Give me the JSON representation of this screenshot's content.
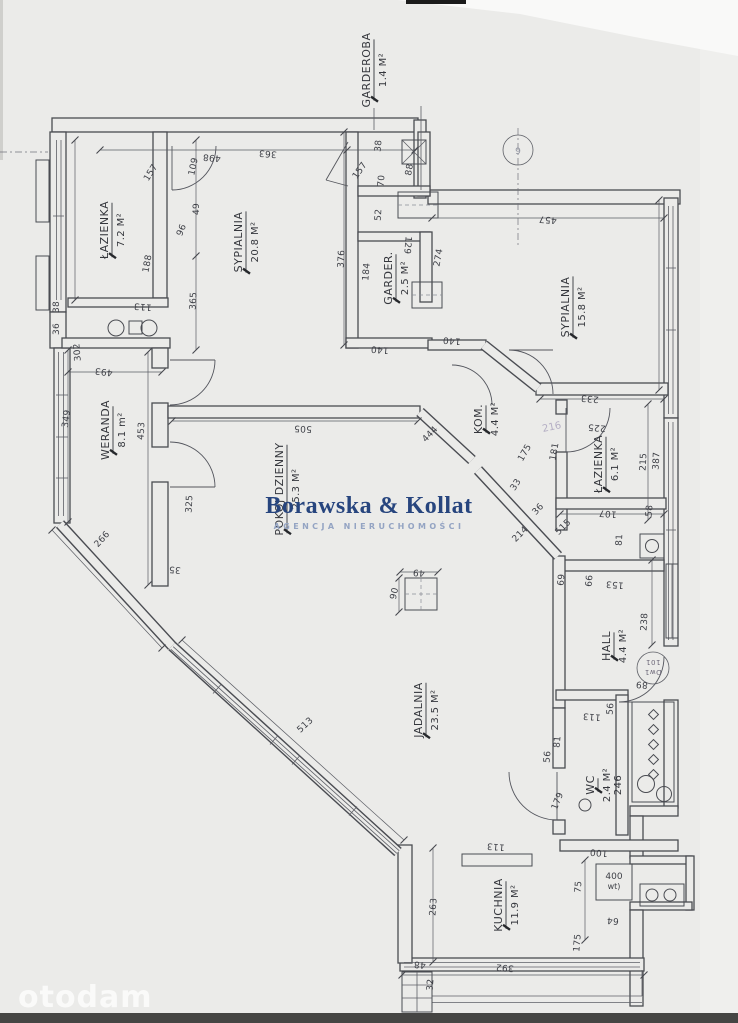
{
  "watermark": {
    "brand": "Borawska & Kollat",
    "subtitle": "AGENCJA NIERUCHOMOŚCI",
    "portal": "otodam"
  },
  "annotations": {
    "grid_marker": "9",
    "entry_stamp_top": "Dw1",
    "entry_stamp_bottom": "101",
    "boiler_top": "400",
    "boiler_bottom": "wt)",
    "corner_stamp": "216"
  },
  "colors": {
    "paper": "#ebebe9",
    "ink": "#4a4c52",
    "brand_navy": "#27457e",
    "brand_light": "#94a4c3",
    "portal_white": "#fbfbfa"
  },
  "rooms": [
    {
      "name": "ŁAZIENKA",
      "area": "7.2 M²",
      "x": 112,
      "y": 230
    },
    {
      "name": "SYPIALNIA",
      "area": "20.8 M²",
      "x": 246,
      "y": 242
    },
    {
      "name": "GARDEROBA",
      "area": "1.4 M²",
      "x": 374,
      "y": 70
    },
    {
      "name": "GARDER.",
      "area": "2.5 M²",
      "x": 396,
      "y": 278
    },
    {
      "name": "SYPIALNIA",
      "area": "15.8 M²",
      "x": 573,
      "y": 307
    },
    {
      "name": "WERANDA",
      "area": "8.1 m²",
      "x": 113,
      "y": 430
    },
    {
      "name": "POKOJ DZIENNY",
      "area": "25.3 M²",
      "x": 287,
      "y": 489
    },
    {
      "name": "KOM.",
      "area": "4.4 M²",
      "x": 486,
      "y": 419
    },
    {
      "name": "ŁAZIENKA",
      "area": "6.1 M²",
      "x": 606,
      "y": 464
    },
    {
      "name": "HALL",
      "area": "4.4 M²",
      "x": 614,
      "y": 646
    },
    {
      "name": "JADALNIA",
      "area": "23.5 M²",
      "x": 426,
      "y": 710
    },
    {
      "name": "WC",
      "area": "2.4 M²",
      "extra": "246",
      "x": 598,
      "y": 785
    },
    {
      "name": "KUCHNIA",
      "area": "11.9 M²",
      "x": 506,
      "y": 905
    }
  ],
  "dimensions": [
    {
      "v": "498",
      "x": 212,
      "y": 155,
      "r": 185
    },
    {
      "v": "363",
      "x": 268,
      "y": 151,
      "r": 185
    },
    {
      "v": "302",
      "x": 80,
      "y": 352,
      "r": -95
    },
    {
      "v": "157",
      "x": 153,
      "y": 174,
      "r": -58
    },
    {
      "v": "109",
      "x": 196,
      "y": 167,
      "r": -78
    },
    {
      "v": "49",
      "x": 199,
      "y": 209,
      "r": -90
    },
    {
      "v": "96",
      "x": 184,
      "y": 231,
      "r": -68
    },
    {
      "v": "188",
      "x": 150,
      "y": 264,
      "r": -80
    },
    {
      "v": "365",
      "x": 196,
      "y": 301,
      "r": -87
    },
    {
      "v": "113",
      "x": 143,
      "y": 304,
      "r": 185
    },
    {
      "v": "38",
      "x": 59,
      "y": 307,
      "r": -90
    },
    {
      "v": "36",
      "x": 59,
      "y": 329,
      "r": -90
    },
    {
      "v": "493",
      "x": 104,
      "y": 369,
      "r": 186
    },
    {
      "v": "349",
      "x": 69,
      "y": 419,
      "r": -82
    },
    {
      "v": "453",
      "x": 144,
      "y": 431,
      "r": -87
    },
    {
      "v": "325",
      "x": 192,
      "y": 504,
      "r": -87
    },
    {
      "v": "266",
      "x": 104,
      "y": 541,
      "r": -47
    },
    {
      "v": "35",
      "x": 175,
      "y": 567,
      "r": 185
    },
    {
      "v": "513",
      "x": 307,
      "y": 727,
      "r": -43
    },
    {
      "v": "38",
      "x": 381,
      "y": 146,
      "r": -85
    },
    {
      "v": "88",
      "x": 412,
      "y": 170,
      "r": -80
    },
    {
      "v": "157",
      "x": 362,
      "y": 172,
      "r": -55
    },
    {
      "v": "70",
      "x": 384,
      "y": 181,
      "r": -85
    },
    {
      "v": "52",
      "x": 381,
      "y": 215,
      "r": -86
    },
    {
      "v": "376",
      "x": 344,
      "y": 259,
      "r": -87
    },
    {
      "v": "184",
      "x": 369,
      "y": 272,
      "r": -85
    },
    {
      "v": "129",
      "x": 405,
      "y": 245,
      "r": 95
    },
    {
      "v": "274",
      "x": 441,
      "y": 258,
      "r": -80
    },
    {
      "v": "140",
      "x": 452,
      "y": 338,
      "r": 185
    },
    {
      "v": "140",
      "x": 380,
      "y": 347,
      "r": 185
    },
    {
      "v": "505",
      "x": 303,
      "y": 426,
      "r": 182
    },
    {
      "v": "444",
      "x": 432,
      "y": 436,
      "r": -46
    },
    {
      "v": "457",
      "x": 548,
      "y": 217,
      "r": 185
    },
    {
      "v": "387",
      "x": 659,
      "y": 461,
      "r": -87
    },
    {
      "v": "233",
      "x": 590,
      "y": 396,
      "r": 185
    },
    {
      "v": "225",
      "x": 597,
      "y": 425,
      "r": 185
    },
    {
      "v": "175",
      "x": 527,
      "y": 454,
      "r": -60
    },
    {
      "v": "181",
      "x": 557,
      "y": 452,
      "r": -80
    },
    {
      "v": "215",
      "x": 646,
      "y": 462,
      "r": -87
    },
    {
      "v": "33",
      "x": 518,
      "y": 486,
      "r": -58
    },
    {
      "v": "36",
      "x": 540,
      "y": 511,
      "r": -47
    },
    {
      "v": "214",
      "x": 522,
      "y": 536,
      "r": -45
    },
    {
      "v": "515",
      "x": 565,
      "y": 529,
      "r": -45
    },
    {
      "v": "107",
      "x": 608,
      "y": 511,
      "r": 185
    },
    {
      "v": "58",
      "x": 652,
      "y": 511,
      "r": -85
    },
    {
      "v": "81",
      "x": 622,
      "y": 540,
      "r": -87
    },
    {
      "v": "153",
      "x": 615,
      "y": 582,
      "r": 185
    },
    {
      "v": "69",
      "x": 564,
      "y": 580,
      "r": -85
    },
    {
      "v": "66",
      "x": 592,
      "y": 581,
      "r": -85
    },
    {
      "v": "238",
      "x": 647,
      "y": 622,
      "r": -87
    },
    {
      "v": "89",
      "x": 642,
      "y": 682,
      "r": 185
    },
    {
      "v": "56",
      "x": 613,
      "y": 709,
      "r": -85
    },
    {
      "v": "113",
      "x": 592,
      "y": 714,
      "r": 185
    },
    {
      "v": "56",
      "x": 550,
      "y": 757,
      "r": -85
    },
    {
      "v": "81",
      "x": 560,
      "y": 742,
      "r": -85
    },
    {
      "v": "179",
      "x": 560,
      "y": 802,
      "r": -68
    },
    {
      "v": "100",
      "x": 599,
      "y": 850,
      "r": 185
    },
    {
      "v": "75",
      "x": 581,
      "y": 887,
      "r": -85
    },
    {
      "v": "64",
      "x": 613,
      "y": 918,
      "r": 185
    },
    {
      "v": "175",
      "x": 580,
      "y": 943,
      "r": -85
    },
    {
      "v": "113",
      "x": 496,
      "y": 844,
      "r": 185
    },
    {
      "v": "263",
      "x": 436,
      "y": 907,
      "r": -86
    },
    {
      "v": "392",
      "x": 505,
      "y": 965,
      "r": 185
    },
    {
      "v": "48",
      "x": 420,
      "y": 962,
      "r": 185
    },
    {
      "v": "32",
      "x": 433,
      "y": 985,
      "r": -85
    },
    {
      "v": "49",
      "x": 419,
      "y": 570,
      "r": 185
    },
    {
      "v": "90",
      "x": 397,
      "y": 594,
      "r": -78
    }
  ]
}
